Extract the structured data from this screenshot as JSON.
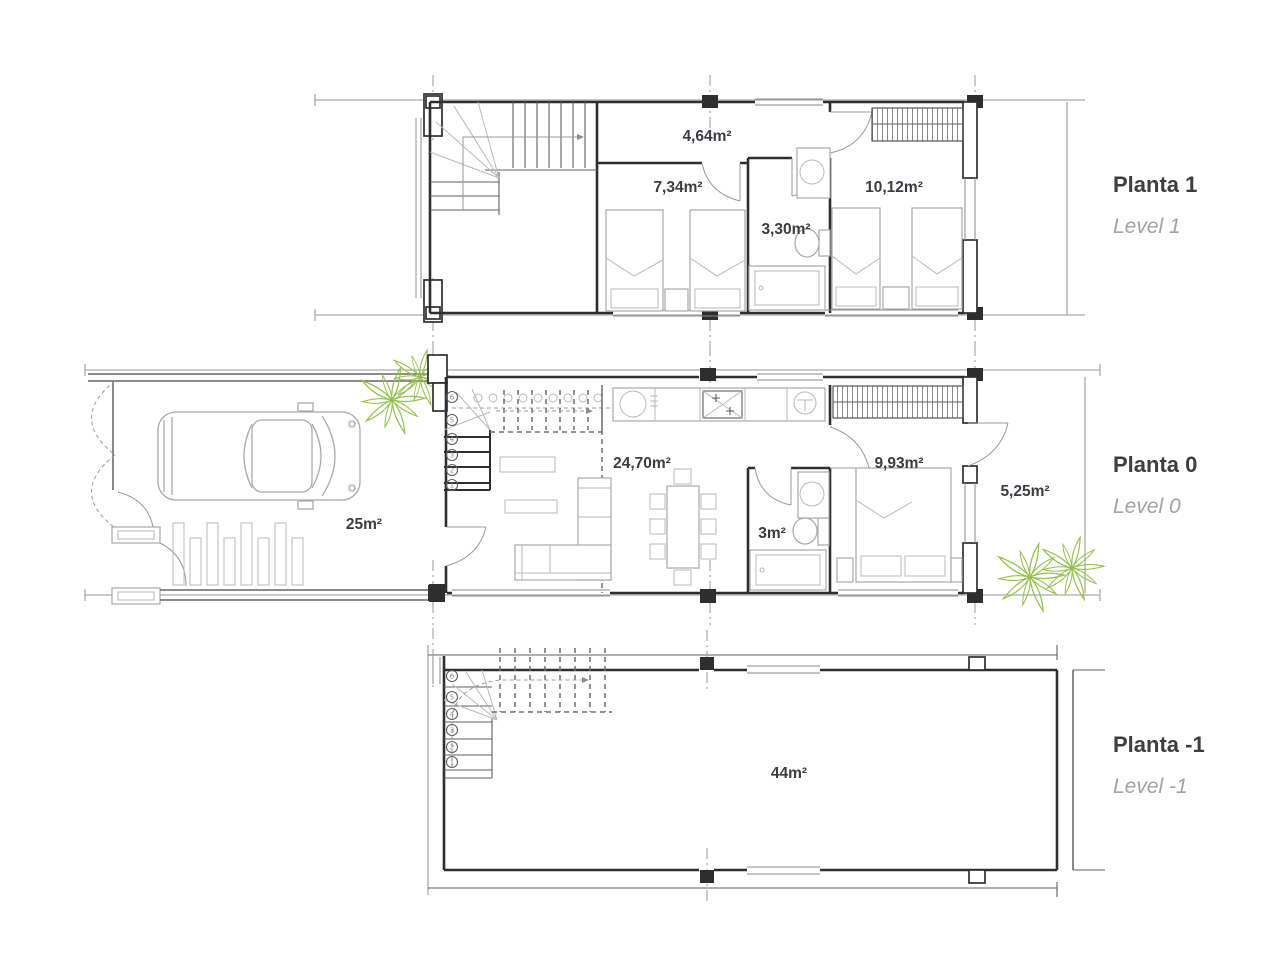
{
  "palette": {
    "wall": "#2e2e2e",
    "guide": "#a9a9a9",
    "furniture": "#a8a8a8",
    "plant_green": "#94c04e",
    "area_label": "#3b3b44",
    "title": "#3e3e3e",
    "subtitle": "#a2a2a2"
  },
  "levels": [
    {
      "title": "Planta 1",
      "subtitle": "Level 1",
      "rooms": [
        {
          "name": "landing-hall",
          "area": "4,64m²"
        },
        {
          "name": "bedroom-1",
          "area": "7,34m²"
        },
        {
          "name": "bathroom",
          "area": "3,30m²"
        },
        {
          "name": "bedroom-2",
          "area": "10,12m²"
        }
      ]
    },
    {
      "title": "Planta 0",
      "subtitle": "Level 0",
      "rooms": [
        {
          "name": "garage",
          "area": "25m²"
        },
        {
          "name": "living-dining",
          "area": "24,70m²"
        },
        {
          "name": "bathroom",
          "area": "3m²"
        },
        {
          "name": "bedroom",
          "area": "9,93m²"
        },
        {
          "name": "terrace",
          "area": "5,25m²"
        }
      ],
      "stair_numbers": [
        "6",
        "5",
        "4",
        "3",
        "2",
        "1"
      ]
    },
    {
      "title": "Planta -1",
      "subtitle": "Level -1",
      "rooms": [
        {
          "name": "basement",
          "area": "44m²"
        }
      ],
      "stair_numbers": [
        "6",
        "5",
        "4",
        "3",
        "2",
        "1"
      ]
    }
  ]
}
